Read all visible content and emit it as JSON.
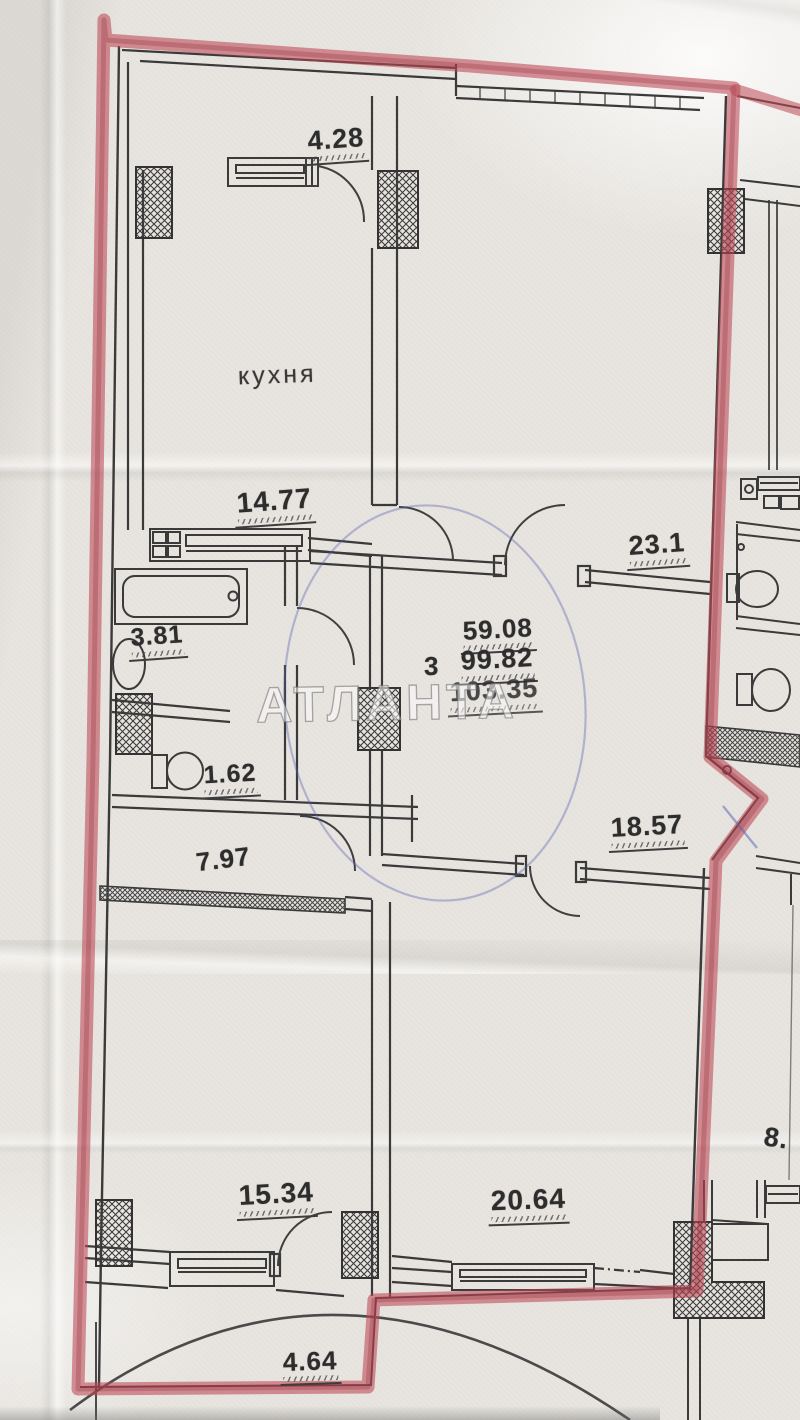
{
  "watermark": {
    "text": "АТЛАНТА"
  },
  "labels": {
    "top_width": "4.28",
    "kitchen_name": "кухня",
    "kitchen_area": "14.77",
    "room_top_right": "23.1",
    "bathroom": "3.81",
    "rooms_count": "3",
    "living_area": "59.08",
    "apartment_area": "99.82",
    "total_area": "103.35",
    "wc": "1.62",
    "hallway": "7.97",
    "room_mid_right": "18.57",
    "room_bottom_left": "15.34",
    "room_bottom_right": "20.64",
    "balcony": "4.64",
    "neighbor_partial": "8."
  },
  "colors": {
    "marker_red": "#bc4854",
    "ink_black": "#3a3a3a",
    "pen_blue": "#5a64af",
    "paper": "#e8e5e0"
  }
}
